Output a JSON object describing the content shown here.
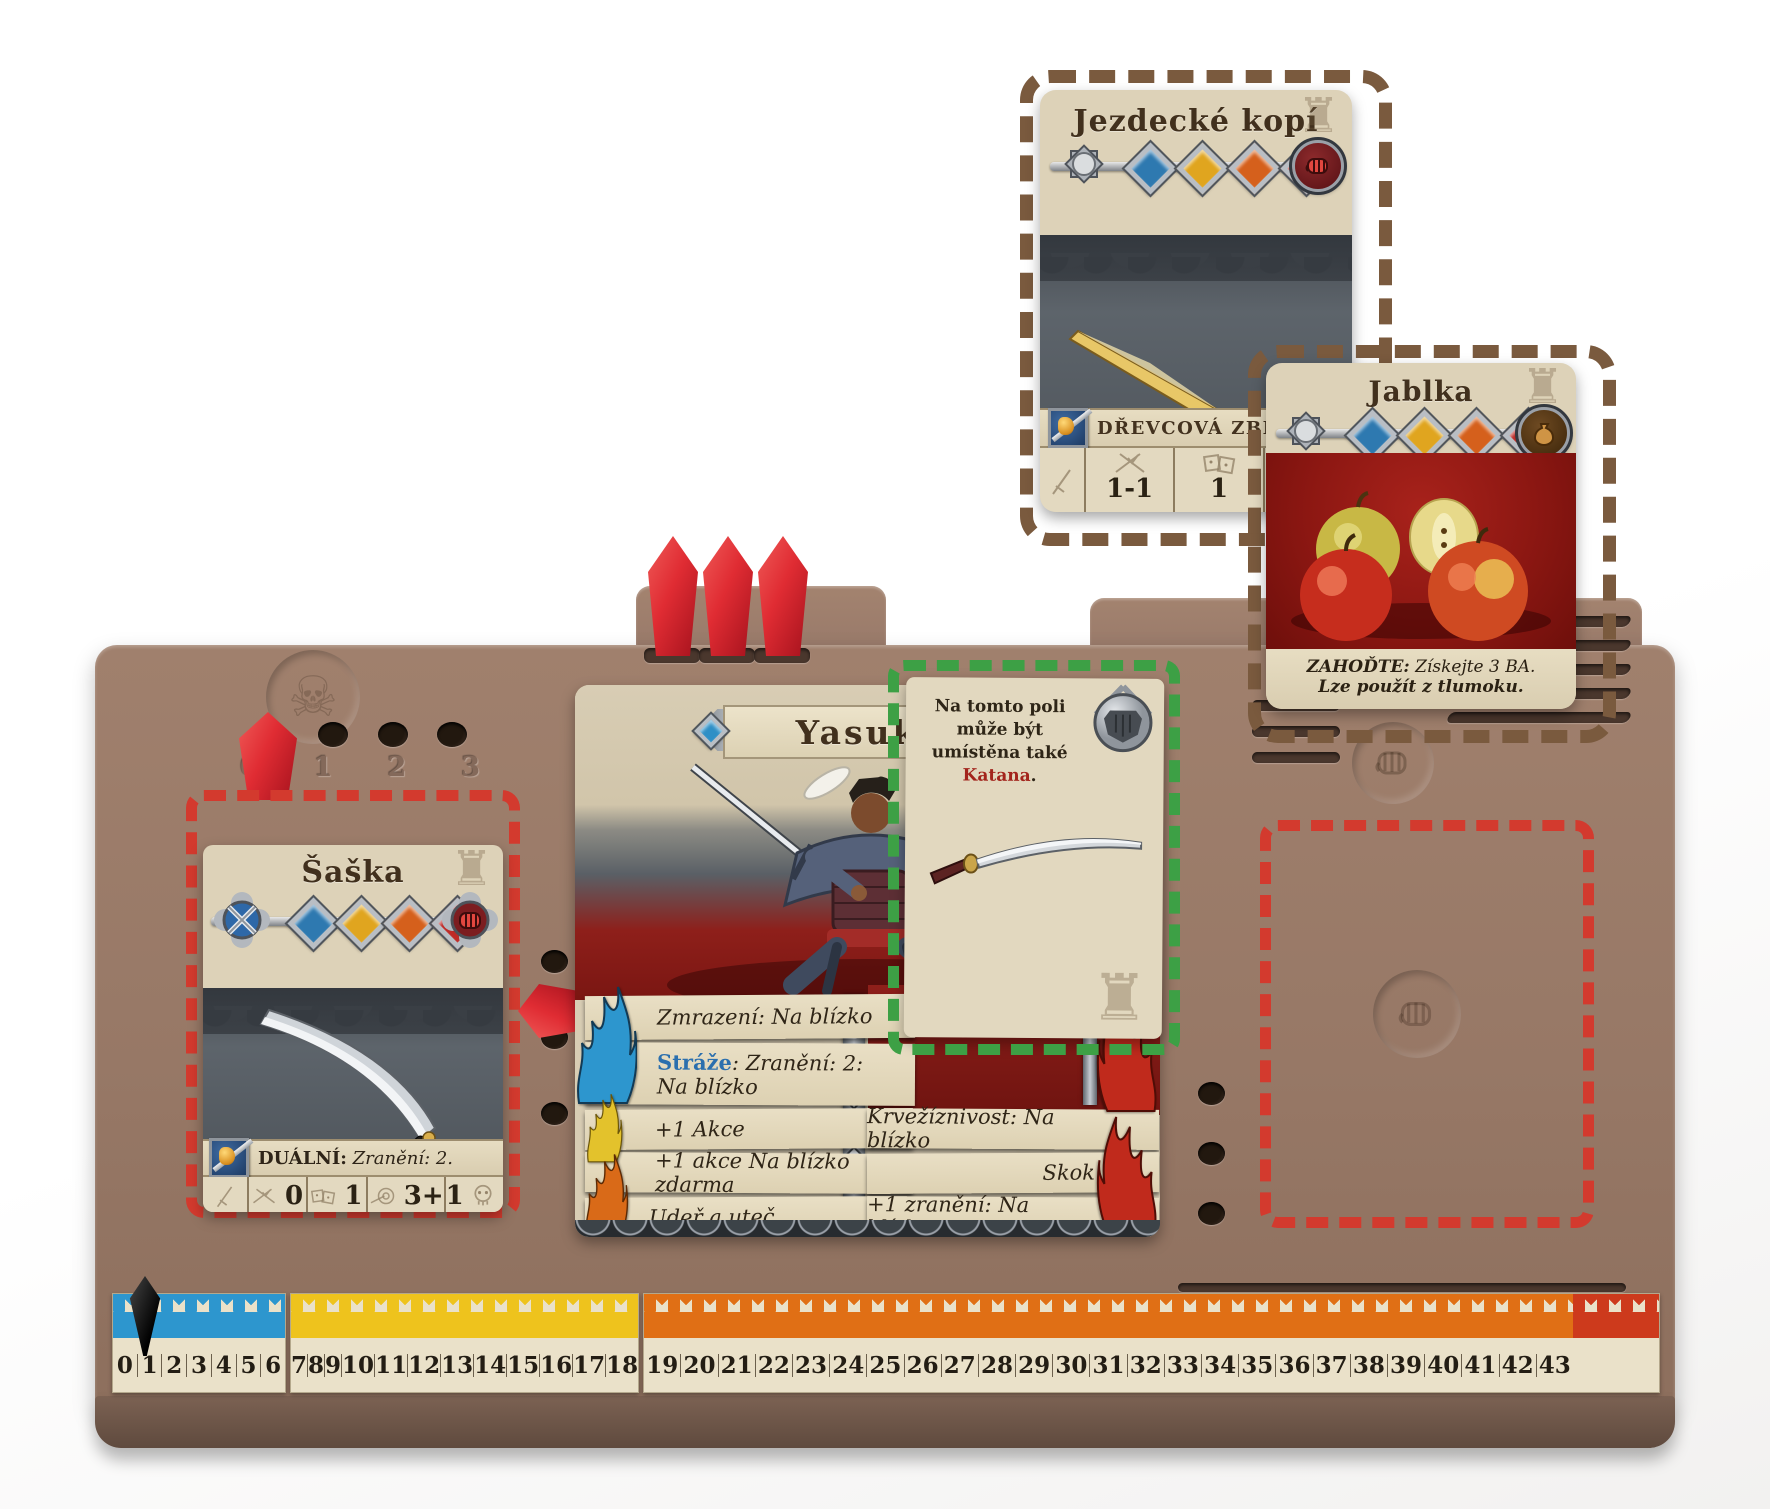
{
  "board": {
    "wound_track_numbers": [
      "0",
      "1",
      "2",
      "3"
    ],
    "skull_glyph": "☠",
    "tower_glyph": "♜"
  },
  "track": {
    "marker_position": "0",
    "segments": [
      {
        "flame_color": "#2d96ce",
        "numbers": [
          "0",
          "1",
          "2",
          "3",
          "4",
          "5",
          "6"
        ]
      },
      {
        "flame_color": "#eec31d",
        "numbers": [
          "7",
          "8",
          "9",
          "10",
          "11",
          "12",
          "13",
          "14",
          "15",
          "16",
          "17",
          "18"
        ]
      },
      {
        "flame_color": "#e06f15",
        "numbers": [
          "19",
          "20",
          "21",
          "22",
          "23",
          "24",
          "25",
          "26",
          "27",
          "28",
          "29",
          "30",
          "31",
          "32",
          "33",
          "34",
          "35",
          "36",
          "37",
          "38",
          "39",
          "40",
          "41",
          "42",
          "43"
        ]
      }
    ],
    "end_flame_color": "#cd3a1c"
  },
  "cards": {
    "jezdecke_kopi": {
      "title": "Jezdecké kopí",
      "type_label": "DŘEVCOVÁ ZBRAŇ",
      "stats": [
        {
          "name": "attack",
          "value": "1-1"
        },
        {
          "name": "defense",
          "value": "1"
        },
        {
          "name": "range",
          "value": "3+"
        }
      ]
    },
    "jablka": {
      "title": "Jablka",
      "line1_bold": "ZAHOĎTE:",
      "line1_rest": " Získejte 3 BA.",
      "line2": "Lze použít z tlumoku."
    },
    "saska": {
      "title": "Šaška",
      "ability_bold": "DUÁLNÍ:",
      "ability_rest": " Zranění: 2.",
      "stats": [
        {
          "name": "attack",
          "value": "0"
        },
        {
          "name": "defense",
          "value": "1"
        },
        {
          "name": "range",
          "value": "3+"
        },
        {
          "name": "wounds",
          "value": "1"
        }
      ]
    },
    "yasuke": {
      "title": "Yasuke",
      "ability_zmrazeni": "Zmrazení: Na blízko",
      "ability_straze_bold": "Stráže",
      "ability_straze_rest": ": Zranění: 2:",
      "ability_straze_line2": "Na blízko",
      "left_abilities": [
        "+1 Akce",
        "+1 akce Na blízko zdarma",
        "Udeř a uteč"
      ],
      "right_abilities": [
        "Krvežíznivost: Na blízko",
        "Skok",
        "+1 zranění: Na blízko"
      ]
    },
    "katana_slot": {
      "text_before": "Na tomto poli může být umístěna také ",
      "highlight": "Katana",
      "text_after": "."
    }
  }
}
